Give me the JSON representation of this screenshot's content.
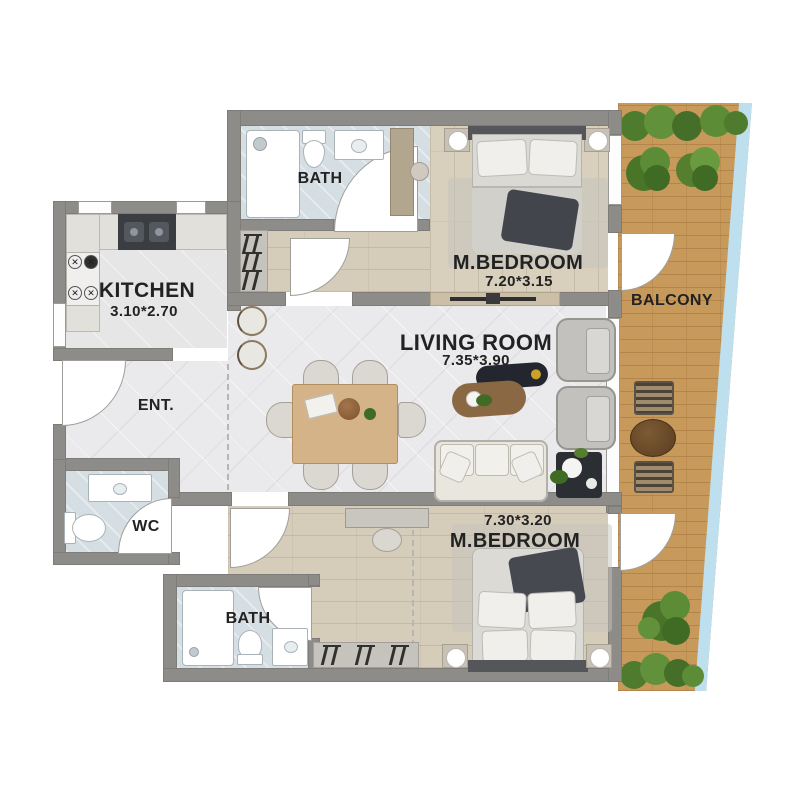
{
  "plan": {
    "rooms": {
      "bath_top": {
        "name": "BATH"
      },
      "bedroom_top": {
        "name": "M.BEDROOM",
        "dims": "7.20*3.15"
      },
      "balcony": {
        "name": "BALCONY"
      },
      "kitchen": {
        "name": "KITCHEN",
        "dims": "3.10*2.70"
      },
      "living_room": {
        "name": "LIVING ROOM",
        "dims": "7.35*3.90"
      },
      "entrance": {
        "name": "ENT."
      },
      "wc": {
        "name": "WC"
      },
      "bath_bottom": {
        "name": "BATH"
      },
      "bedroom_bottom": {
        "name": "M.BEDROOM",
        "dims": "7.30*3.20"
      }
    },
    "colors": {
      "wall": "#8e8c89",
      "tile_floor": "#eae9eb",
      "wood_floor": "#d8cfbd",
      "bath_floor": "#d5dee3",
      "balcony_floor": "#c79a5c",
      "railing_glass": "#bedfee",
      "greenery": "#4e7b2d",
      "label_text": "#222222"
    }
  }
}
